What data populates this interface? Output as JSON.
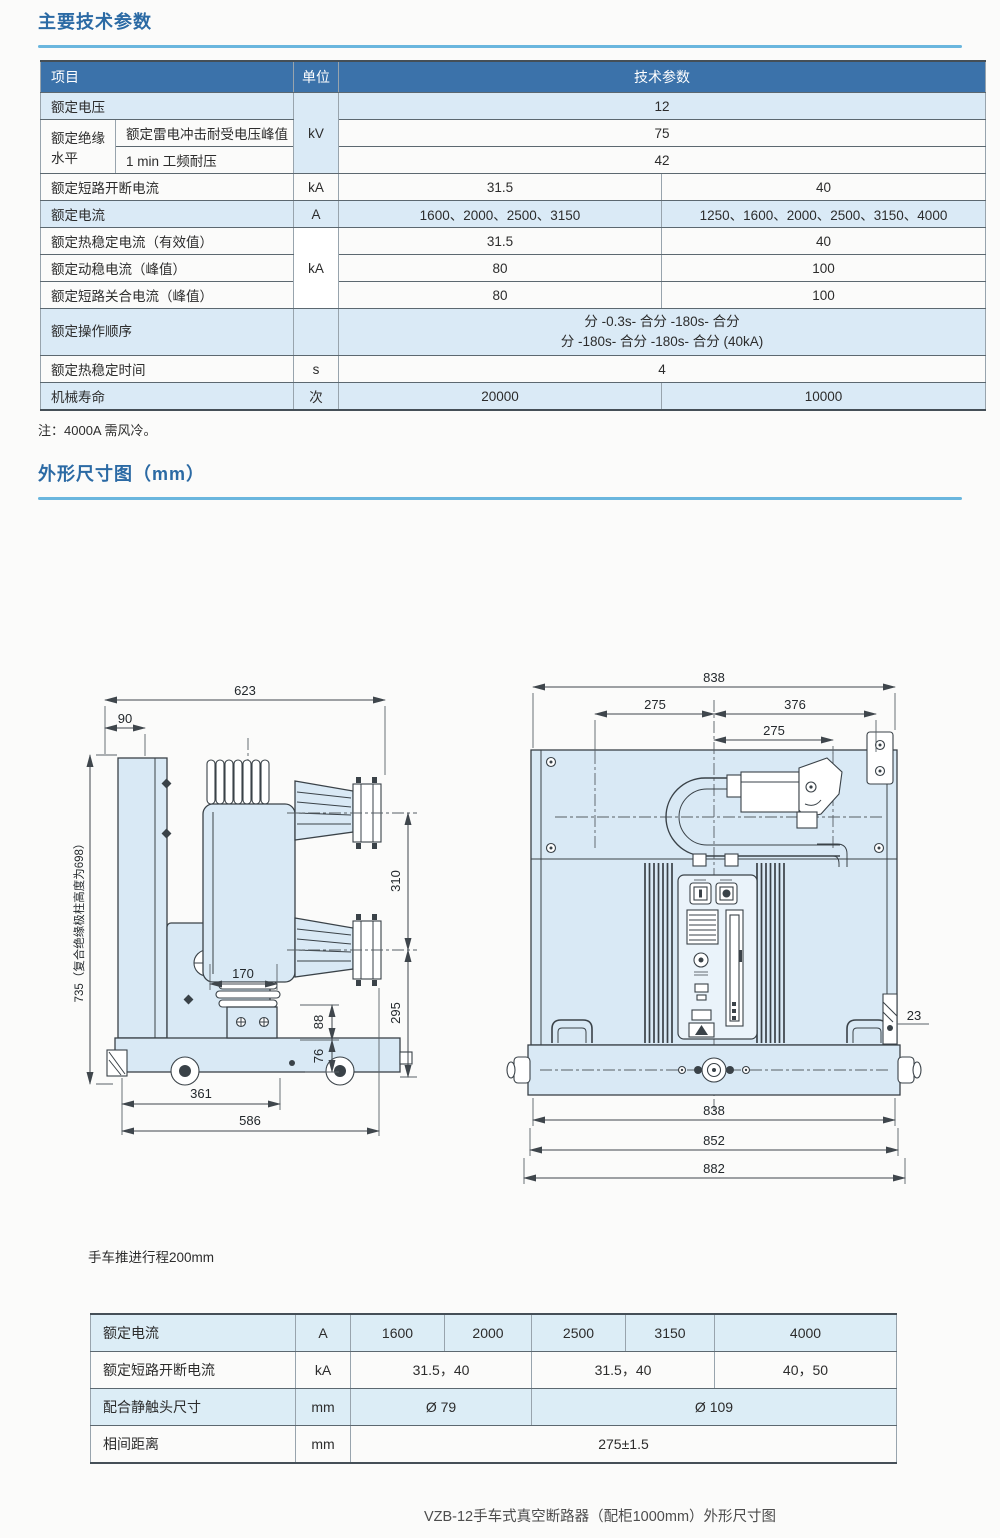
{
  "page": {
    "section1_title": "主要技术参数",
    "note": "注：4000A 需风冷。",
    "section2_title": "外形尺寸图（mm）",
    "travel_note": "手车推进行程200mm",
    "caption": "VZB-12手车式真空断路器（配柜1000mm）外形尺寸图"
  },
  "main_table": {
    "header": {
      "item": "项目",
      "unit": "单位",
      "value": "技术参数"
    },
    "r1": {
      "label": "额定电压",
      "unit": "kV",
      "value": "12"
    },
    "r2a": "额定绝缘水平",
    "r2": {
      "label": "额定雷电冲击耐受电压峰值",
      "value": "75"
    },
    "r3": {
      "label": "1 min 工频耐压",
      "value": "42"
    },
    "r4": {
      "label": "额定短路开断电流",
      "unit": "kA",
      "v1": "31.5",
      "v2": "40"
    },
    "r5": {
      "label": "额定电流",
      "unit": "A",
      "v1": "1600、2000、2500、3150",
      "v2": "1250、1600、2000、2500、3150、4000"
    },
    "r6": {
      "label": "额定热稳定电流（有效值）",
      "unit": "kA",
      "v1": "31.5",
      "v2": "40"
    },
    "r7": {
      "label": "额定动稳电流（峰值）",
      "v1": "80",
      "v2": "100"
    },
    "r8": {
      "label": "额定短路关合电流（峰值）",
      "v1": "80",
      "v2": "100"
    },
    "r9": {
      "label": "额定操作顺序",
      "l1": "分 -0.3s- 合分 -180s- 合分",
      "l2": "分 -180s- 合分 -180s- 合分 (40kA)"
    },
    "r10": {
      "label": "额定热稳定时间",
      "unit": "s",
      "value": "4"
    },
    "r11": {
      "label": "机械寿命",
      "unit": "次",
      "v1": "20000",
      "v2": "10000"
    }
  },
  "side_view": {
    "d623": "623",
    "d90": "90",
    "d735": "735（复合绝缘极柱高度为698）",
    "d310": "310",
    "d295": "295",
    "d170": "170",
    "d88": "88",
    "d76": "76",
    "d361": "361",
    "d586": "586"
  },
  "front_view": {
    "t838": "838",
    "d275a": "275",
    "d376": "376",
    "d275b": "275",
    "d23": "23",
    "b838": "838",
    "b852": "852",
    "b882": "882"
  },
  "bottom_table": {
    "r1": {
      "label": "额定电流",
      "unit": "A",
      "c1": "1600",
      "c2": "2000",
      "c3": "2500",
      "c4": "3150",
      "c5": "4000"
    },
    "r2": {
      "label": "额定短路开断电流",
      "unit": "kA",
      "v1": "31.5，40",
      "v2": "31.5，40",
      "v3": "40，50"
    },
    "r3": {
      "label": "配合静触头尺寸",
      "unit": "mm",
      "v1": "Ø 79",
      "v2": "Ø 109"
    },
    "r4": {
      "label": "相间距离",
      "unit": "mm",
      "v1": "275±1.5"
    }
  }
}
